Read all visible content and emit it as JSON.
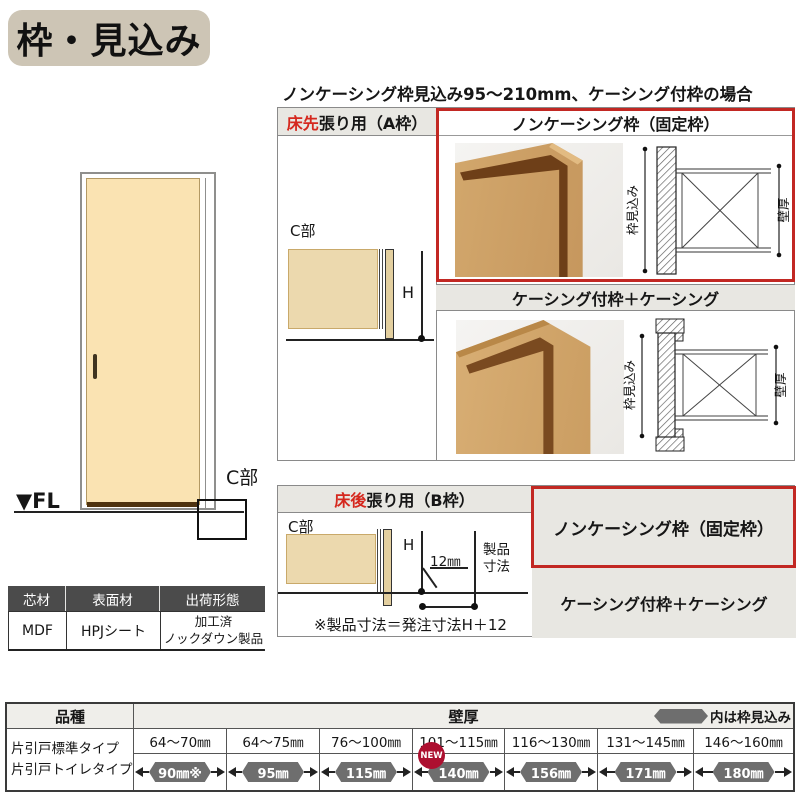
{
  "title": "枠・見込み",
  "subtitle": "ノンケーシング枠見込み95～210mm、ケーシング付枠の場合",
  "door": {
    "fl_label": "▼FL",
    "c_label": "C部"
  },
  "spec_table": {
    "headers": [
      "芯材",
      "表面材",
      "出荷形態"
    ],
    "core": "MDF",
    "surface": "HPJシート",
    "shipping_line1": "加工済",
    "shipping_line2": "ノックダウン製品"
  },
  "section_a": {
    "header_left_em": "床先",
    "header_left_rest": "張り用（A枠）",
    "noncasing_label": "ノンケーシング枠（固定枠）",
    "casing_label": "ケーシング付枠＋ケーシング",
    "c_label": "C部",
    "h_label": "H",
    "dim_depth": "枠見込み",
    "dim_wall": "壁厚"
  },
  "section_b": {
    "header_left_em": "床後",
    "header_left_rest": "張り用（B枠）",
    "noncasing_label": "ノンケーシング枠（固定枠）",
    "casing_label": "ケーシング付枠＋ケーシング",
    "c_label": "C部",
    "h_label": "H",
    "dim_12": "12㎜",
    "product_dim_line1": "製品",
    "product_dim_line2": "寸法",
    "note": "※製品寸法＝発注寸法H＋12"
  },
  "bottom_table": {
    "kind_header": "品種",
    "wall_header": "壁厚",
    "legend_label": "内は枠見込み",
    "kind_line1": "片引戸標準タイプ",
    "kind_line2": "片引戸トイレタイプ",
    "wall_ranges": [
      "64～70㎜",
      "64～75㎜",
      "76～100㎜",
      "101～115㎜",
      "116～130㎜",
      "131～145㎜",
      "146～160㎜"
    ],
    "frame_depths": [
      "90㎜※",
      "95㎜",
      "115㎜",
      "140㎜",
      "156㎜",
      "171㎜",
      "180㎜"
    ],
    "new_badge": "NEW"
  },
  "colors": {
    "accent_red": "#c22823",
    "em_text_red": "#d5281e",
    "title_badge_bg": "#cdc5b5",
    "header_gray": "#e8e7e2",
    "spec_header_dark": "#4b4b4b",
    "hexagon_gray": "#6e6e6e",
    "new_badge_red": "#ad1030",
    "door_cream": "#fae3b2",
    "diagram_tan": "#ecd9ae"
  }
}
